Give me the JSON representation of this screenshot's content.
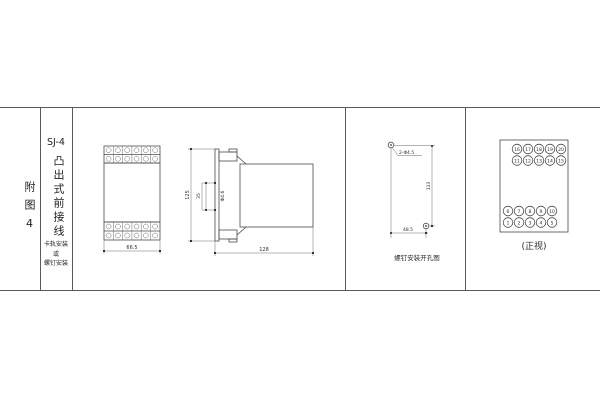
{
  "title_block": {
    "figure_label": "附图4",
    "model": "SJ-4",
    "wiring_type": "凸出式前接线",
    "mount_note_line1": "卡轨安装",
    "mount_note_line2": "或",
    "mount_note_line3": "螺钉安装"
  },
  "front_view": {
    "width_dim": "66.5"
  },
  "side_view": {
    "height_dim": "125",
    "rail_dim": "35",
    "hole_label": "Φ4.6",
    "depth_dim": "128"
  },
  "drill_view": {
    "holes_label": "2-Φ4.5",
    "height_dim": "113",
    "width_dim": "48.5",
    "caption": "螺钉安装开孔图"
  },
  "terminal_view": {
    "caption": "(正视)",
    "row1": [
      "16",
      "17",
      "18",
      "19",
      "20"
    ],
    "row2": [
      "11",
      "12",
      "13",
      "14",
      "15"
    ],
    "row3": [
      "6",
      "7",
      "8",
      "9",
      "10"
    ],
    "row4": [
      "1",
      "2",
      "3",
      "4",
      "5"
    ]
  },
  "colors": {
    "line": "#4a4a4a",
    "text": "#2e2e2e",
    "background": "#ffffff"
  }
}
